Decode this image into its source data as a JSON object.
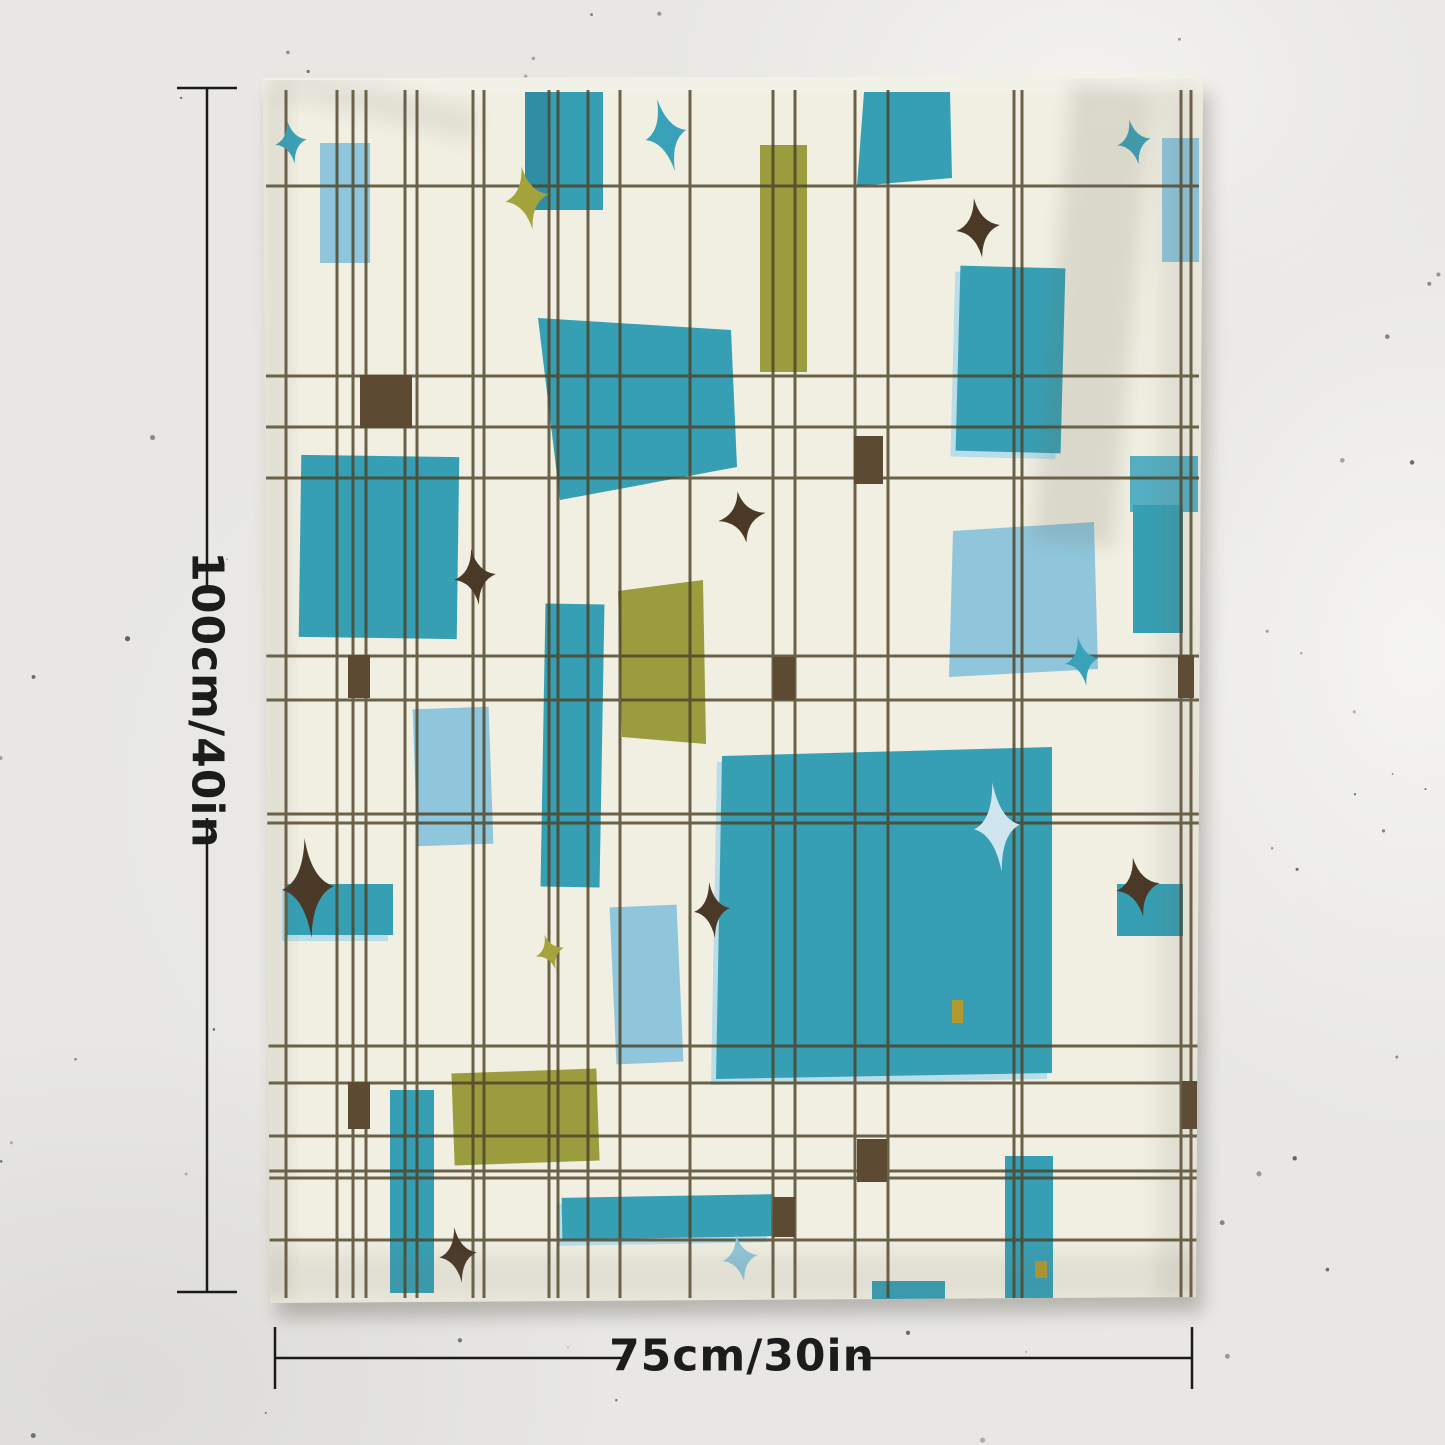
{
  "product": {
    "description": "Mid-century modern abstract tapestry hanging on a speckled plaster wall",
    "height_label": "100cm/40in",
    "width_label": "75cm/30in"
  },
  "palette": {
    "wall": "#e8e7e4",
    "speck": "#4a463f",
    "fabric": "#f0efe2",
    "hem": "#f2f1e8",
    "shadow": "#3a372f",
    "line": "#4e4228",
    "teal": "#379fb4",
    "teal_dark": "#2f8ea3",
    "teal_light": "#55aec2",
    "teal_star": "#3aa2b8",
    "lightblue": "#8fc6db",
    "pale": "#cfe6f0",
    "pale_sliver": "#b9dde9",
    "olive": "#9b9c3e",
    "olive_star": "#a5a33c",
    "brown_sq": "#5d4a33",
    "brown_star": "#4b3928",
    "mustard": "#b2992f",
    "measure": "#1a1a1a"
  },
  "scene": {
    "canvas": {
      "w": 1445,
      "h": 1445
    },
    "fabric_outline": [
      [
        263,
        80
      ],
      [
        1203,
        78
      ],
      [
        1196,
        1297
      ],
      [
        270,
        1303
      ]
    ],
    "hem_strip": [
      [
        263,
        78
      ],
      [
        1203,
        76
      ],
      [
        1203,
        93
      ],
      [
        263,
        95
      ]
    ],
    "grid": {
      "v": [
        286,
        337,
        353,
        366,
        405,
        417,
        473,
        484,
        549,
        558,
        588,
        620,
        690,
        773,
        795,
        855,
        888,
        1014,
        1022,
        1181,
        1191
      ],
      "h": [
        186,
        376,
        427,
        478,
        656,
        700,
        814,
        823,
        1046,
        1083,
        1136,
        1171,
        1178,
        1240
      ],
      "v_span": [
        90,
        1298
      ],
      "h_span": [
        266,
        1199
      ],
      "width": 3,
      "opacity": 0.82
    },
    "rects": [
      {
        "x": 320,
        "y": 143,
        "w": 50,
        "h": 120,
        "rot": 0,
        "c": "lightblue"
      },
      {
        "x": 1162,
        "y": 138,
        "w": 37,
        "h": 124,
        "rot": 0,
        "c": "lightblue"
      },
      {
        "x": 415,
        "y": 708,
        "w": 76,
        "h": 137,
        "rot": -2,
        "c": "lightblue"
      },
      {
        "x": 613,
        "y": 906,
        "w": 67,
        "h": 157,
        "rot": -2.5,
        "c": "lightblue"
      },
      {
        "x": 525,
        "y": 92,
        "w": 78,
        "h": 118,
        "rot": 0,
        "c": "teal"
      },
      {
        "x": 525,
        "y": 92,
        "w": 22,
        "h": 118,
        "rot": 0,
        "c": "teal_dark"
      },
      {
        "x": 958,
        "y": 267,
        "w": 105,
        "h": 185,
        "rot": 1.5,
        "c": "teal",
        "sliver": true
      },
      {
        "x": 300,
        "y": 456,
        "w": 158,
        "h": 182,
        "rot": 0.8,
        "c": "teal"
      },
      {
        "x": 543,
        "y": 604,
        "w": 59,
        "h": 283,
        "rot": 1,
        "c": "teal"
      },
      {
        "x": 287,
        "y": 884,
        "w": 106,
        "h": 51,
        "rot": 0,
        "c": "teal",
        "sliver": true
      },
      {
        "x": 1130,
        "y": 456,
        "w": 68,
        "h": 56,
        "rot": 0,
        "c": "teal_light"
      },
      {
        "x": 1133,
        "y": 505,
        "w": 50,
        "h": 128,
        "rot": 0,
        "c": "teal"
      },
      {
        "x": 390,
        "y": 1090,
        "w": 44,
        "h": 203,
        "rot": 0,
        "c": "teal"
      },
      {
        "x": 562,
        "y": 1196,
        "w": 210,
        "h": 42,
        "rot": -1,
        "c": "teal",
        "sliver": true
      },
      {
        "x": 872,
        "y": 1281,
        "w": 73,
        "h": 21,
        "rot": 0,
        "c": "teal"
      },
      {
        "x": 1005,
        "y": 1156,
        "w": 48,
        "h": 142,
        "rot": 0,
        "c": "teal"
      },
      {
        "x": 1117,
        "y": 884,
        "w": 66,
        "h": 52,
        "rot": 0,
        "c": "teal"
      },
      {
        "x": 760,
        "y": 145,
        "w": 47,
        "h": 227,
        "rot": 0,
        "c": "olive"
      },
      {
        "x": 453,
        "y": 1071,
        "w": 145,
        "h": 92,
        "rot": -2,
        "c": "olive"
      },
      {
        "x": 360,
        "y": 375,
        "w": 52,
        "h": 53,
        "rot": 0,
        "c": "brown_sq"
      },
      {
        "x": 348,
        "y": 655,
        "w": 22,
        "h": 43,
        "rot": 0,
        "c": "brown_sq"
      },
      {
        "x": 773,
        "y": 657,
        "w": 22,
        "h": 43,
        "rot": 0,
        "c": "brown_sq"
      },
      {
        "x": 1178,
        "y": 655,
        "w": 16,
        "h": 43,
        "rot": 0,
        "c": "brown_sq"
      },
      {
        "x": 854,
        "y": 436,
        "w": 29,
        "h": 48,
        "rot": 0,
        "c": "brown_sq"
      },
      {
        "x": 348,
        "y": 1082,
        "w": 22,
        "h": 47,
        "rot": 0,
        "c": "brown_sq"
      },
      {
        "x": 773,
        "y": 1197,
        "w": 22,
        "h": 40,
        "rot": 0,
        "c": "brown_sq"
      },
      {
        "x": 857,
        "y": 1139,
        "w": 30,
        "h": 43,
        "rot": 0,
        "c": "brown_sq"
      },
      {
        "x": 1182,
        "y": 1081,
        "w": 15,
        "h": 48,
        "rot": 0,
        "c": "brown_sq"
      },
      {
        "x": 952,
        "y": 1000,
        "w": 11,
        "h": 23,
        "rot": 0,
        "c": "mustard"
      },
      {
        "x": 1035,
        "y": 1261,
        "w": 12,
        "h": 17,
        "rot": 0,
        "c": "mustard"
      }
    ],
    "quads": [
      {
        "p": [
          [
            864,
            92
          ],
          [
            950,
            92
          ],
          [
            952,
            178
          ],
          [
            857,
            186
          ]
        ],
        "c": "teal"
      },
      {
        "p": [
          [
            538,
            318
          ],
          [
            731,
            330
          ],
          [
            737,
            467
          ],
          [
            560,
            500
          ]
        ],
        "c": "teal"
      },
      {
        "p": [
          [
            722,
            756
          ],
          [
            1052,
            747
          ],
          [
            1052,
            1073
          ],
          [
            716,
            1079
          ]
        ],
        "c": "teal",
        "sliver": true
      },
      {
        "p": [
          [
            953,
            531
          ],
          [
            1094,
            522
          ],
          [
            1098,
            669
          ],
          [
            949,
            677
          ]
        ],
        "c": "lightblue"
      },
      {
        "p": [
          [
            618,
            591
          ],
          [
            703,
            580
          ],
          [
            706,
            744
          ],
          [
            622,
            737
          ]
        ],
        "c": "olive"
      }
    ],
    "stars": [
      {
        "cx": 291,
        "cy": 142,
        "rx": 16,
        "ry": 22,
        "rot": -10,
        "c": "teal_star"
      },
      {
        "cx": 666,
        "cy": 135,
        "rx": 21,
        "ry": 37,
        "rot": -14,
        "c": "teal_star"
      },
      {
        "cx": 1134,
        "cy": 142,
        "rx": 17,
        "ry": 23,
        "rot": -12,
        "c": "teal_star"
      },
      {
        "cx": 527,
        "cy": 198,
        "rx": 22,
        "ry": 32,
        "rot": -10,
        "c": "olive_star"
      },
      {
        "cx": 978,
        "cy": 228,
        "rx": 22,
        "ry": 30,
        "rot": -8,
        "c": "brown_star"
      },
      {
        "cx": 742,
        "cy": 517,
        "rx": 24,
        "ry": 26,
        "rot": -10,
        "c": "brown_star"
      },
      {
        "cx": 475,
        "cy": 577,
        "rx": 21,
        "ry": 28,
        "rot": -8,
        "c": "brown_star"
      },
      {
        "cx": 1082,
        "cy": 661,
        "rx": 17,
        "ry": 25,
        "rot": -10,
        "c": "teal_star"
      },
      {
        "cx": 997,
        "cy": 827,
        "rx": 23,
        "ry": 45,
        "rot": -6,
        "c": "pale"
      },
      {
        "cx": 712,
        "cy": 910,
        "rx": 18,
        "ry": 28,
        "rot": -6,
        "c": "brown_star"
      },
      {
        "cx": 308,
        "cy": 888,
        "rx": 26,
        "ry": 50,
        "rot": -4,
        "c": "brown_star"
      },
      {
        "cx": 550,
        "cy": 952,
        "rx": 15,
        "ry": 18,
        "rot": -18,
        "c": "olive_star"
      },
      {
        "cx": 458,
        "cy": 1255,
        "rx": 19,
        "ry": 28,
        "rot": -8,
        "c": "brown_star"
      },
      {
        "cx": 740,
        "cy": 1258,
        "rx": 18,
        "ry": 24,
        "rot": -10,
        "c": "lightblue"
      },
      {
        "cx": 1138,
        "cy": 887,
        "rx": 22,
        "ry": 30,
        "rot": -10,
        "c": "brown_star"
      }
    ],
    "shading": [
      {
        "x": 1052,
        "y": 85,
        "w": 82,
        "h": 460,
        "rot": 5,
        "op": 0.16
      },
      {
        "x": 263,
        "y": 85,
        "w": 26,
        "h": 1215,
        "rot": 0,
        "op": 0.12
      },
      {
        "x": 1158,
        "y": 85,
        "w": 42,
        "h": 1215,
        "rot": 0,
        "op": 0.1
      },
      {
        "x": 263,
        "y": 1252,
        "w": 940,
        "h": 50,
        "rot": 0,
        "op": 0.1
      },
      {
        "x": 268,
        "y": 84,
        "w": 210,
        "h": 34,
        "rot": 14,
        "op": 0.1
      }
    ],
    "speckles": {
      "count": 130,
      "seed": 42
    },
    "measure": {
      "stroke_width": 2.5,
      "vertical": {
        "x": 207,
        "y1": 88,
        "y2": 1292,
        "gap1": 588,
        "gap2": 818,
        "tick_half": 30
      },
      "horizontal": {
        "y": 1358,
        "x1": 275,
        "x2": 1192,
        "gap1": 627,
        "gap2": 858,
        "tick_half": 31
      }
    }
  }
}
